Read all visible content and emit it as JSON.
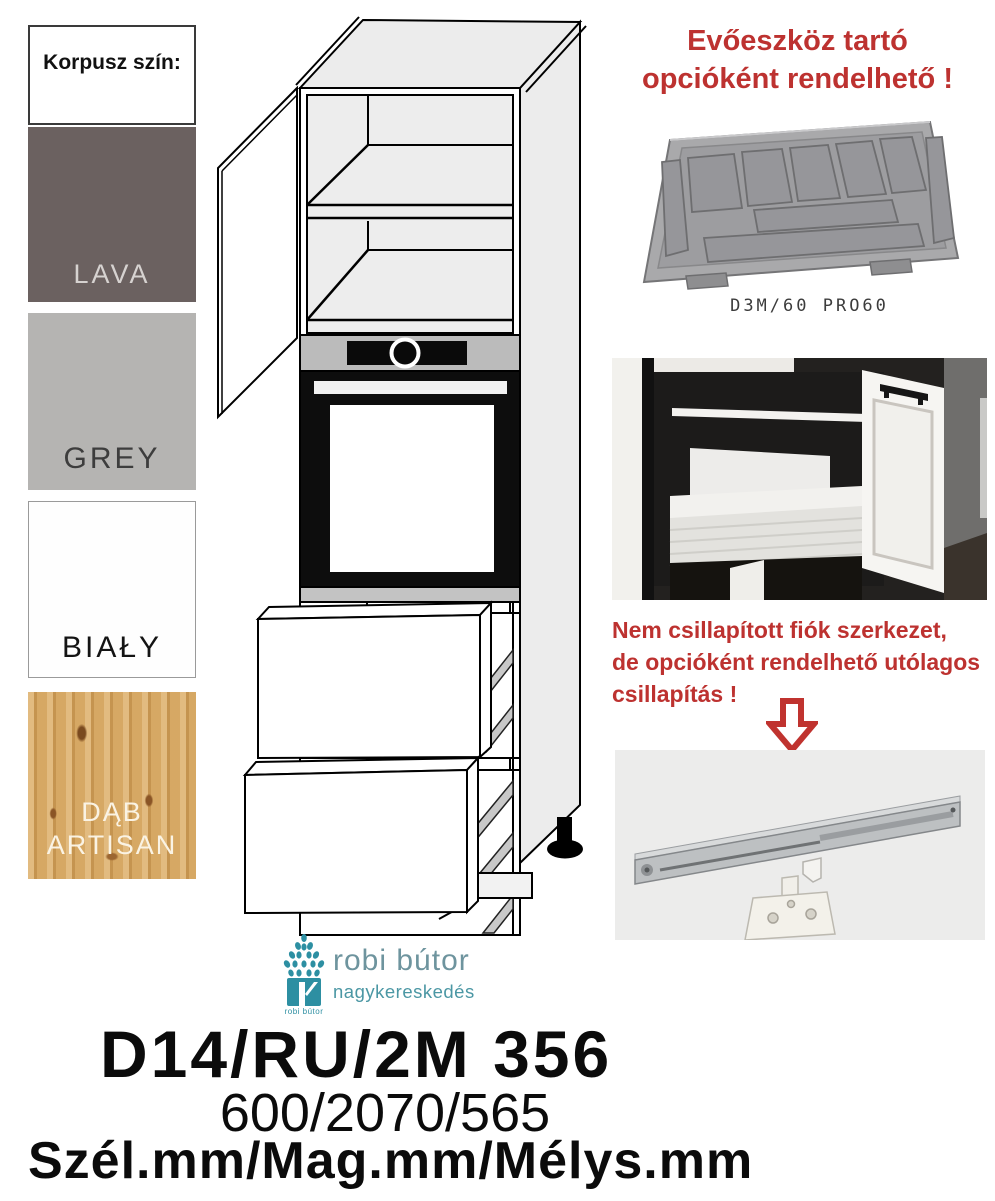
{
  "colors": {
    "accent_red": "#bd3230",
    "logo_teal": "#2d8fa2",
    "logo_grey_teal": "#6e949e",
    "swatch_lava": "#6b6160",
    "swatch_grey": "#b5b4b2",
    "swatch_bialy": "#fefefe",
    "swatch_dab_artisan": "#d2a159"
  },
  "korpusz": {
    "title": "Korpusz szín:",
    "swatches": [
      {
        "name": "lava",
        "label": "LAVA"
      },
      {
        "name": "grey",
        "label": "GREY"
      },
      {
        "name": "bialy",
        "label": "BIAŁY"
      },
      {
        "name": "dab-artisan",
        "label": "DĄB ARTISAN"
      }
    ]
  },
  "cutlery_note": {
    "line1": "Evőeszköz tartó",
    "line2": "opcióként rendelhető !",
    "product_code": "D3M/60 PRO60"
  },
  "damping_note": {
    "lines": [
      "Nem csillapított fiók szerkezet,",
      "de opcióként rendelhető utólagos",
      "csillapítás !"
    ]
  },
  "logo": {
    "name": "robi bútor",
    "subtitle": "nagykereskedés",
    "icon_caption": "robi bútor"
  },
  "product": {
    "code": "D14/RU/2M 356",
    "dimensions": "600/2070/565",
    "dimensions_caption": "Szél.mm/Mag.mm/Mélys.mm"
  }
}
